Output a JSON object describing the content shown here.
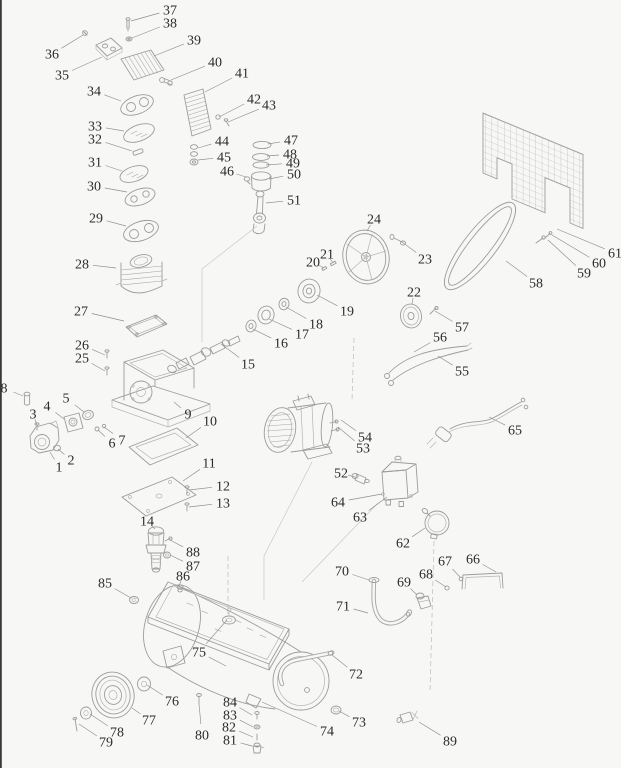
{
  "meta": {
    "description": "Exploded parts diagram of a belt-driven air compressor with numbered callouts",
    "background_color": "#f7f7f5",
    "line_color": "#9c9c9c",
    "label_color": "#2b2b2b"
  },
  "parts": [
    {
      "n": "1",
      "l": [
        59,
        467
      ],
      "t": [
        50,
        452
      ]
    },
    {
      "n": "2",
      "l": [
        71,
        460
      ],
      "t": [
        58,
        449
      ]
    },
    {
      "n": "3",
      "l": [
        33,
        414
      ],
      "t": [
        37,
        425
      ]
    },
    {
      "n": "4",
      "l": [
        47,
        406
      ],
      "t": [
        64,
        419
      ]
    },
    {
      "n": "5",
      "l": [
        66,
        398
      ],
      "t": [
        84,
        412
      ]
    },
    {
      "n": "6",
      "l": [
        112,
        443
      ],
      "t": [
        98,
        430
      ]
    },
    {
      "n": "7",
      "l": [
        122,
        440
      ],
      "t": [
        104,
        427
      ]
    },
    {
      "n": "8",
      "l": [
        4,
        388
      ],
      "t": [
        23,
        396
      ]
    },
    {
      "n": "9",
      "l": [
        188,
        414
      ],
      "t": [
        174,
        402
      ]
    },
    {
      "n": "10",
      "l": [
        210,
        421
      ],
      "t": [
        186,
        438
      ]
    },
    {
      "n": "11",
      "l": [
        209,
        463
      ],
      "t": [
        183,
        481
      ]
    },
    {
      "n": "12",
      "l": [
        223,
        486
      ],
      "t": [
        189,
        490
      ]
    },
    {
      "n": "13",
      "l": [
        223,
        503
      ],
      "t": [
        189,
        507
      ]
    },
    {
      "n": "14",
      "l": [
        147,
        521
      ],
      "t": [
        155,
        529
      ]
    },
    {
      "n": "15",
      "l": [
        248,
        364
      ],
      "t": [
        221,
        344
      ]
    },
    {
      "n": "16",
      "l": [
        281,
        343
      ],
      "t": [
        253,
        329
      ]
    },
    {
      "n": "17",
      "l": [
        302,
        334
      ],
      "t": [
        269,
        319
      ]
    },
    {
      "n": "18",
      "l": [
        316,
        324
      ],
      "t": [
        286,
        307
      ]
    },
    {
      "n": "19",
      "l": [
        347,
        311
      ],
      "t": [
        317,
        295
      ]
    },
    {
      "n": "20",
      "l": [
        313,
        262
      ],
      "t": [
        324,
        268
      ]
    },
    {
      "n": "21",
      "l": [
        327,
        254
      ],
      "t": [
        333,
        263
      ]
    },
    {
      "n": "22",
      "l": [
        414,
        292
      ],
      "t": [
        412,
        304
      ]
    },
    {
      "n": "23",
      "l": [
        425,
        259
      ],
      "t": [
        402,
        242
      ]
    },
    {
      "n": "24",
      "l": [
        374,
        219
      ],
      "t": [
        367,
        231
      ]
    },
    {
      "n": "25",
      "l": [
        82,
        358
      ],
      "t": [
        105,
        371
      ]
    },
    {
      "n": "26",
      "l": [
        82,
        345
      ],
      "t": [
        105,
        355
      ]
    },
    {
      "n": "27",
      "l": [
        81,
        311
      ],
      "t": [
        124,
        321
      ]
    },
    {
      "n": "28",
      "l": [
        82,
        264
      ],
      "t": [
        116,
        268
      ]
    },
    {
      "n": "29",
      "l": [
        96,
        218
      ],
      "t": [
        126,
        226
      ]
    },
    {
      "n": "30",
      "l": [
        94,
        186
      ],
      "t": [
        127,
        192
      ]
    },
    {
      "n": "31",
      "l": [
        95,
        162
      ],
      "t": [
        122,
        171
      ]
    },
    {
      "n": "32",
      "l": [
        95,
        139
      ],
      "t": [
        132,
        151
      ]
    },
    {
      "n": "33",
      "l": [
        95,
        126
      ],
      "t": [
        124,
        131
      ]
    },
    {
      "n": "34",
      "l": [
        94,
        91
      ],
      "t": [
        121,
        101
      ]
    },
    {
      "n": "35",
      "l": [
        62,
        75
      ],
      "t": [
        102,
        57
      ]
    },
    {
      "n": "36",
      "l": [
        52,
        54
      ],
      "t": [
        83,
        35
      ]
    },
    {
      "n": "37",
      "l": [
        170,
        10
      ],
      "t": [
        131,
        21
      ]
    },
    {
      "n": "38",
      "l": [
        170,
        23
      ],
      "t": [
        132,
        38
      ]
    },
    {
      "n": "39",
      "l": [
        194,
        40
      ],
      "t": [
        154,
        56
      ]
    },
    {
      "n": "40",
      "l": [
        215,
        62
      ],
      "t": [
        171,
        80
      ]
    },
    {
      "n": "41",
      "l": [
        242,
        73
      ],
      "t": [
        205,
        92
      ]
    },
    {
      "n": "42",
      "l": [
        254,
        99
      ],
      "t": [
        219,
        117
      ]
    },
    {
      "n": "43",
      "l": [
        269,
        105
      ],
      "t": [
        228,
        122
      ]
    },
    {
      "n": "44",
      "l": [
        222,
        141
      ],
      "t": [
        198,
        148
      ]
    },
    {
      "n": "45",
      "l": [
        224,
        157
      ],
      "t": [
        198,
        160
      ]
    },
    {
      "n": "46",
      "l": [
        227,
        171
      ],
      "t": [
        246,
        177
      ]
    },
    {
      "n": "47",
      "l": [
        291,
        140
      ],
      "t": [
        268,
        144
      ]
    },
    {
      "n": "48",
      "l": [
        290,
        154
      ],
      "t": [
        267,
        156
      ]
    },
    {
      "n": "49",
      "l": [
        293,
        163
      ],
      "t": [
        266,
        165
      ]
    },
    {
      "n": "50",
      "l": [
        294,
        174
      ],
      "t": [
        269,
        179
      ]
    },
    {
      "n": "51",
      "l": [
        294,
        200
      ],
      "t": [
        266,
        203
      ]
    },
    {
      "n": "52",
      "l": [
        341,
        473
      ],
      "t": [
        355,
        477
      ]
    },
    {
      "n": "53",
      "l": [
        363,
        448
      ],
      "t": [
        338,
        427
      ]
    },
    {
      "n": "54",
      "l": [
        365,
        437
      ],
      "t": [
        341,
        420
      ]
    },
    {
      "n": "55",
      "l": [
        462,
        371
      ],
      "t": [
        438,
        356
      ]
    },
    {
      "n": "56",
      "l": [
        440,
        337
      ],
      "t": [
        414,
        352
      ]
    },
    {
      "n": "57",
      "l": [
        462,
        327
      ],
      "t": [
        435,
        311
      ]
    },
    {
      "n": "58",
      "l": [
        536,
        283
      ],
      "t": [
        506,
        261
      ]
    },
    {
      "n": "59",
      "l": [
        584,
        273
      ],
      "t": [
        548,
        240
      ]
    },
    {
      "n": "60",
      "l": [
        599,
        263
      ],
      "t": [
        552,
        235
      ]
    },
    {
      "n": "61",
      "l": [
        615,
        253
      ],
      "t": [
        557,
        229
      ]
    },
    {
      "n": "62",
      "l": [
        403,
        543
      ],
      "t": [
        425,
        528
      ]
    },
    {
      "n": "63",
      "l": [
        360,
        517
      ],
      "t": [
        387,
        497
      ]
    },
    {
      "n": "64",
      "l": [
        338,
        502
      ],
      "t": [
        382,
        494
      ]
    },
    {
      "n": "65",
      "l": [
        515,
        430
      ],
      "t": [
        489,
        417
      ]
    },
    {
      "n": "66",
      "l": [
        473,
        559
      ],
      "t": [
        496,
        572
      ]
    },
    {
      "n": "67",
      "l": [
        445,
        561
      ],
      "t": [
        460,
        577
      ]
    },
    {
      "n": "68",
      "l": [
        426,
        574
      ],
      "t": [
        446,
        587
      ]
    },
    {
      "n": "69",
      "l": [
        404,
        582
      ],
      "t": [
        417,
        595
      ]
    },
    {
      "n": "70",
      "l": [
        342,
        571
      ],
      "t": [
        369,
        580
      ]
    },
    {
      "n": "71",
      "l": [
        343,
        606
      ],
      "t": [
        368,
        613
      ]
    },
    {
      "n": "72",
      "l": [
        356,
        674
      ],
      "t": [
        332,
        655
      ]
    },
    {
      "n": "73",
      "l": [
        359,
        722
      ],
      "t": [
        339,
        711
      ]
    },
    {
      "n": "74",
      "l": [
        327,
        731
      ],
      "t": [
        262,
        702
      ]
    },
    {
      "n": "75",
      "l": [
        199,
        652
      ],
      "t": [
        227,
        620
      ],
      "t2": [
        226,
        666
      ]
    },
    {
      "n": "76",
      "l": [
        172,
        701
      ],
      "t": [
        147,
        685
      ]
    },
    {
      "n": "77",
      "l": [
        149,
        720
      ],
      "t": [
        132,
        708
      ]
    },
    {
      "n": "78",
      "l": [
        117,
        732
      ],
      "t": [
        90,
        714
      ]
    },
    {
      "n": "79",
      "l": [
        106,
        742
      ],
      "t": [
        79,
        724
      ]
    },
    {
      "n": "80",
      "l": [
        202,
        735
      ],
      "t": [
        199,
        704
      ]
    },
    {
      "n": "81",
      "l": [
        230,
        740
      ],
      "t": [
        252,
        746
      ]
    },
    {
      "n": "82",
      "l": [
        229,
        727
      ],
      "t": [
        253,
        737
      ]
    },
    {
      "n": "83",
      "l": [
        230,
        715
      ],
      "t": [
        253,
        727
      ]
    },
    {
      "n": "84",
      "l": [
        230,
        702
      ],
      "t": [
        252,
        715
      ]
    },
    {
      "n": "85",
      "l": [
        105,
        583
      ],
      "t": [
        131,
        598
      ]
    },
    {
      "n": "86",
      "l": [
        183,
        576
      ],
      "t": [
        179,
        586
      ]
    },
    {
      "n": "87",
      "l": [
        193,
        566
      ],
      "t": [
        170,
        555
      ]
    },
    {
      "n": "88",
      "l": [
        193,
        552
      ],
      "t": [
        170,
        540
      ]
    },
    {
      "n": "89",
      "l": [
        450,
        741
      ],
      "t": [
        419,
        722
      ]
    }
  ]
}
